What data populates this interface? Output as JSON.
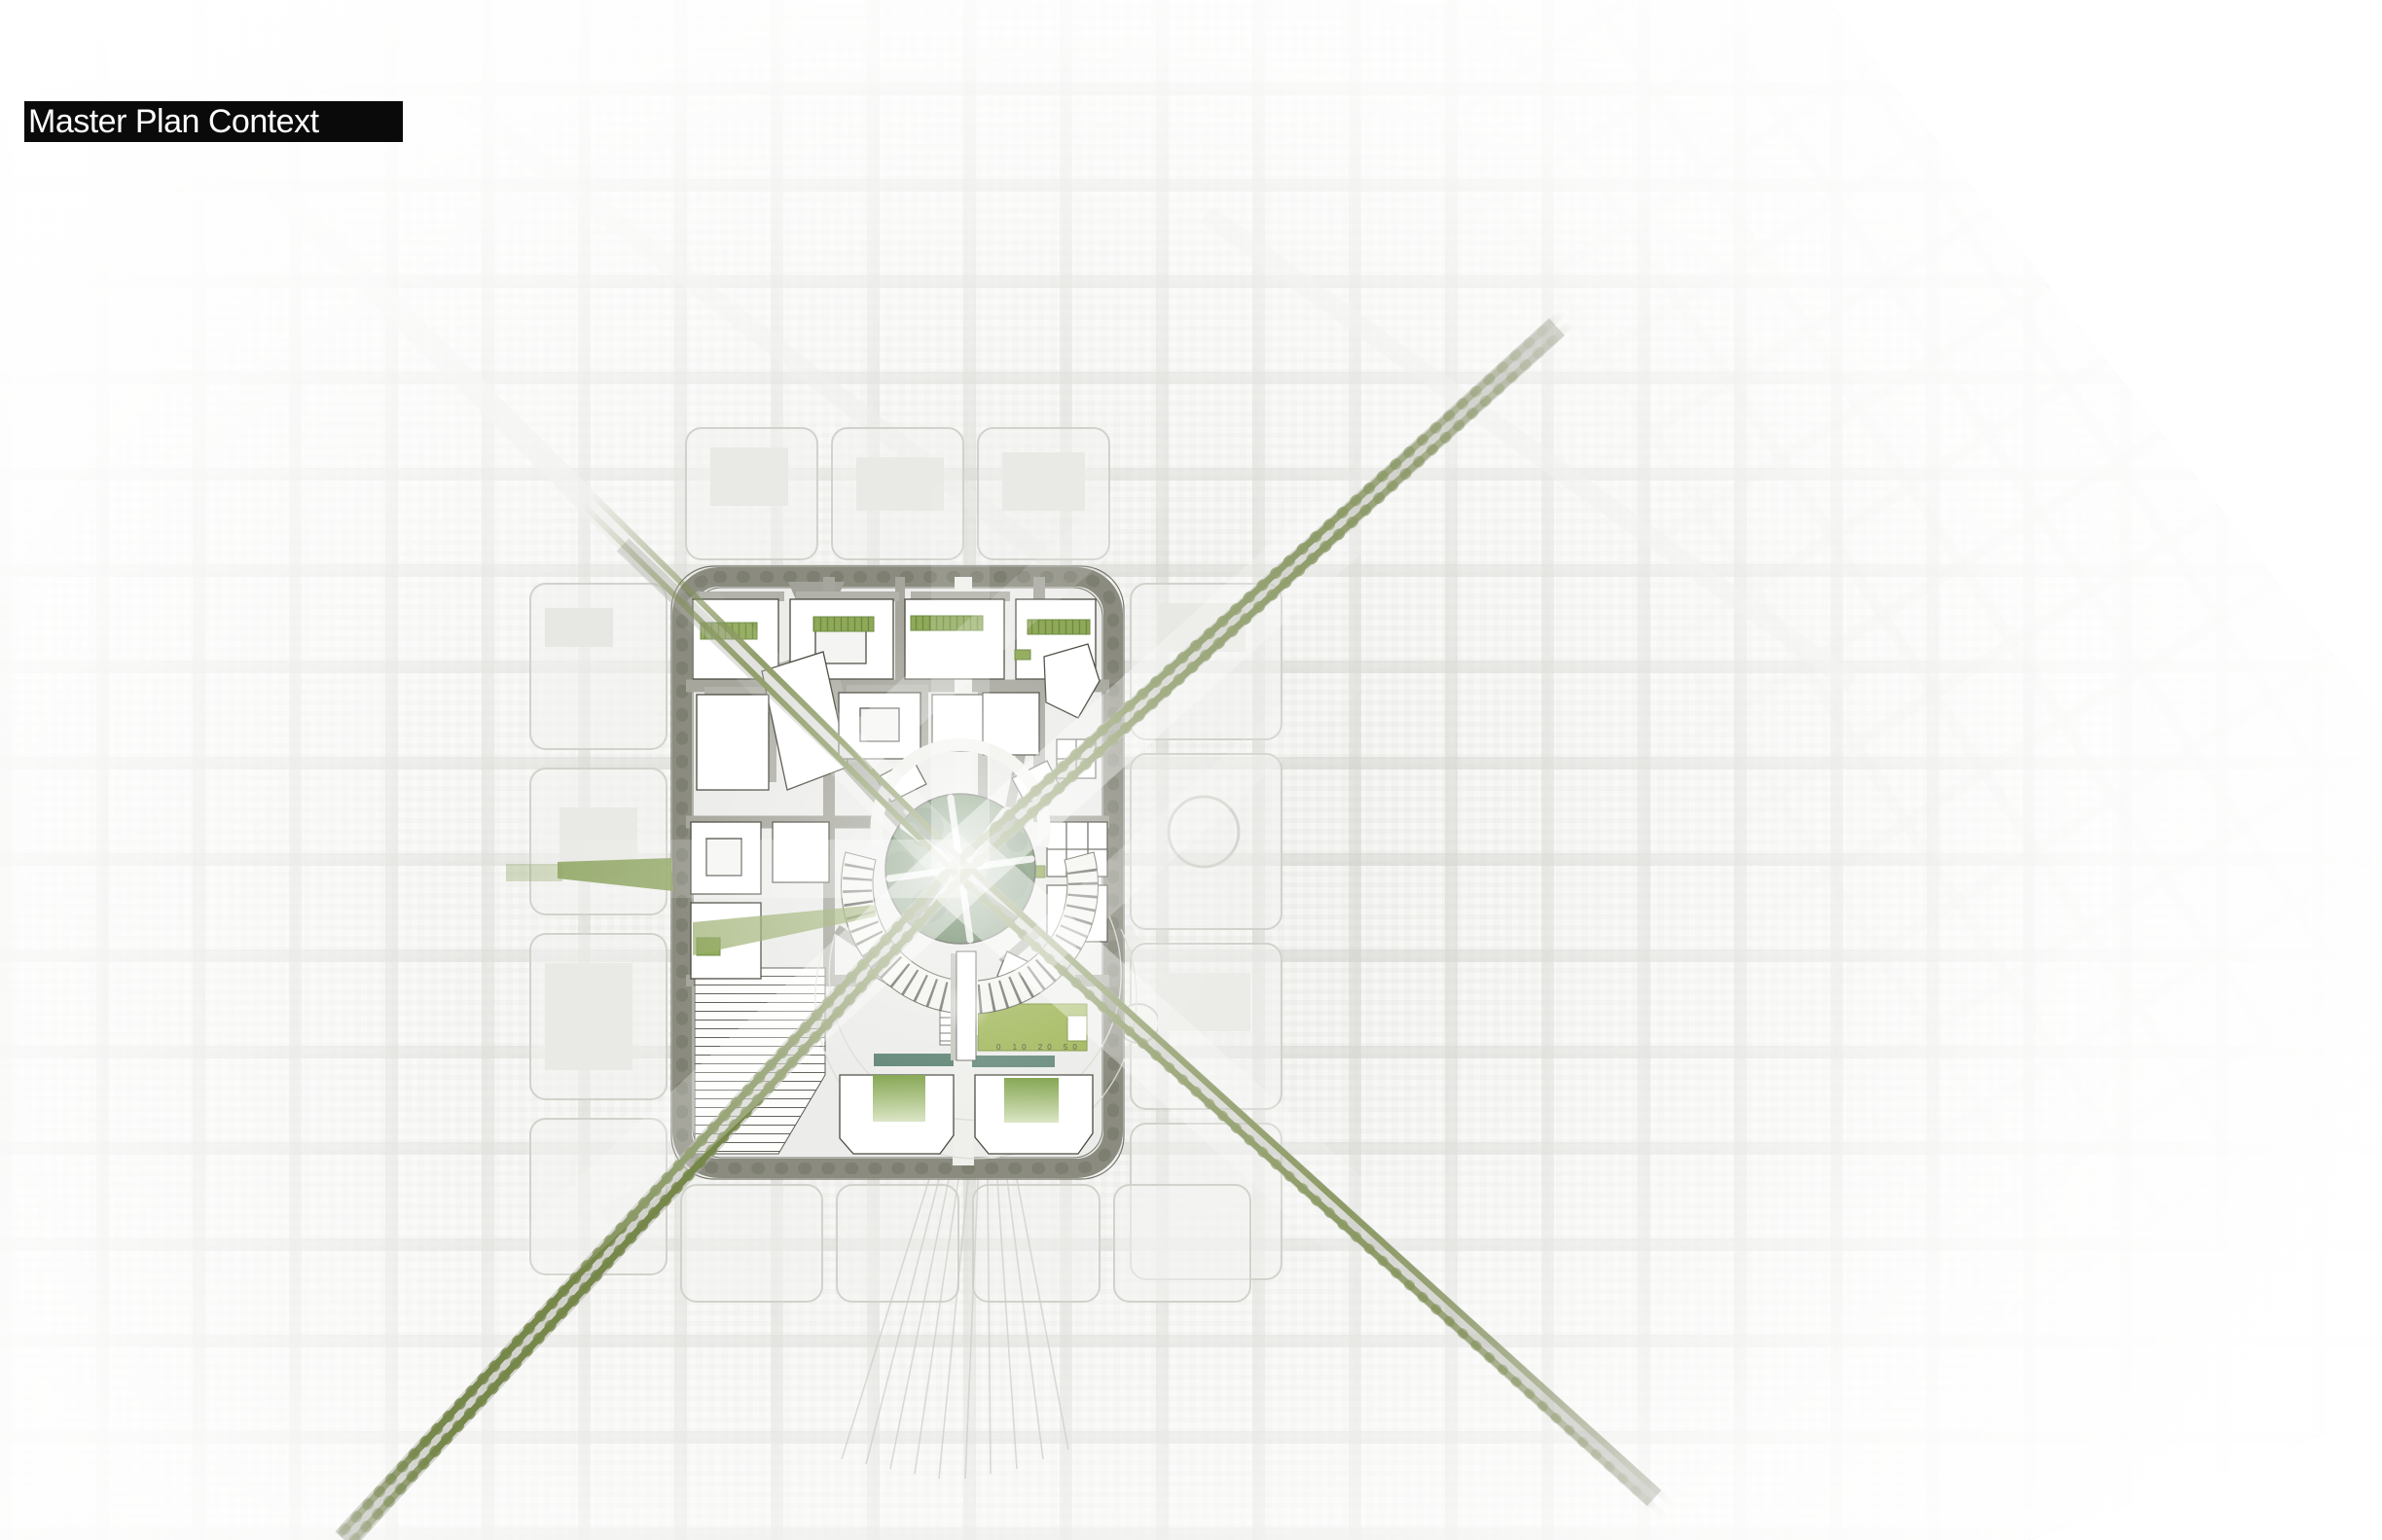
{
  "header": {
    "title": "Master Plan Context"
  },
  "map": {
    "scale_bar_labels": "0 10 20 50",
    "palette": {
      "title_bg": "#0a0a0a",
      "title_text": "#ffffff",
      "aerial_base": "#f5f5f3",
      "aerial_street": "#c9c9c3",
      "ring_road": "#8b8b7f",
      "street_gray": "#a6a69d",
      "building_fill": "#ffffff",
      "building_outline": "#4a4a40",
      "shadow_gray": "#b2b2aa",
      "avenue_green": "#76874a",
      "park_green_dark": "#5e7b58",
      "park_green_light": "#8ba683",
      "lawn_green": "#a2b85c",
      "courtyard_green": "#86a650",
      "teal_strip": "#5c8273"
    }
  }
}
